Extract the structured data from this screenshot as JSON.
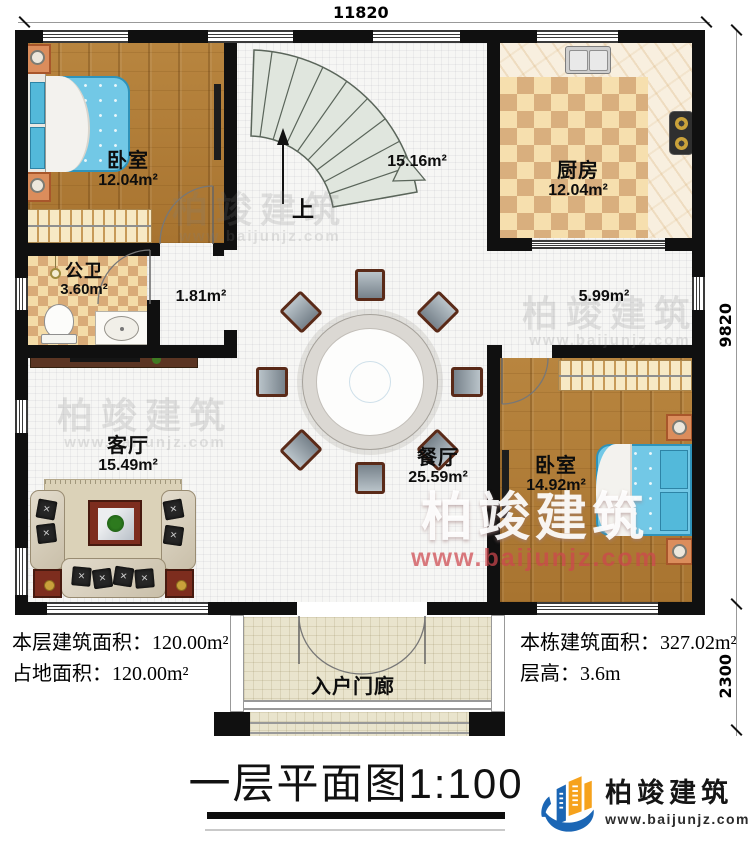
{
  "dim_top": "11820",
  "dim_right_upper": "9820",
  "dim_right_lower": "2300",
  "rooms": {
    "bedroom_left": {
      "name": "卧室",
      "area": "12.04m²"
    },
    "kitchen": {
      "name": "厨房",
      "area": "12.04m²"
    },
    "bathroom": {
      "name": "公卫",
      "area": "3.60m²"
    },
    "living": {
      "name": "客厅",
      "area": "15.49m²"
    },
    "dining": {
      "name": "餐厅",
      "area": "25.59m²"
    },
    "bedroom_right": {
      "name": "卧室",
      "area": "14.92m²"
    },
    "porch": {
      "name": "入户门廊"
    },
    "stair_hall": {
      "area": "15.16m²",
      "up_label": "上"
    },
    "hallway": {
      "area": "1.81m²"
    },
    "corridor": {
      "area": "5.99m²"
    }
  },
  "stats": {
    "left_line1": "本层建筑面积：120.00m²",
    "left_line2": "占地面积：120.00m²",
    "right_line1": "本栋建筑面积：327.02m²",
    "right_line2": "层高：3.6m"
  },
  "title": "一层平面图1:100",
  "brand": {
    "name": "柏竣建筑",
    "website": "www.baijunjz.com"
  },
  "watermark": {
    "name": "柏竣建筑",
    "website": "www.baijunjz.com"
  },
  "colors": {
    "wall": "#101010",
    "logo_blue": "#1b66b5",
    "logo_orange": "#f6a21c",
    "bed_blue": "#72c8e6"
  }
}
